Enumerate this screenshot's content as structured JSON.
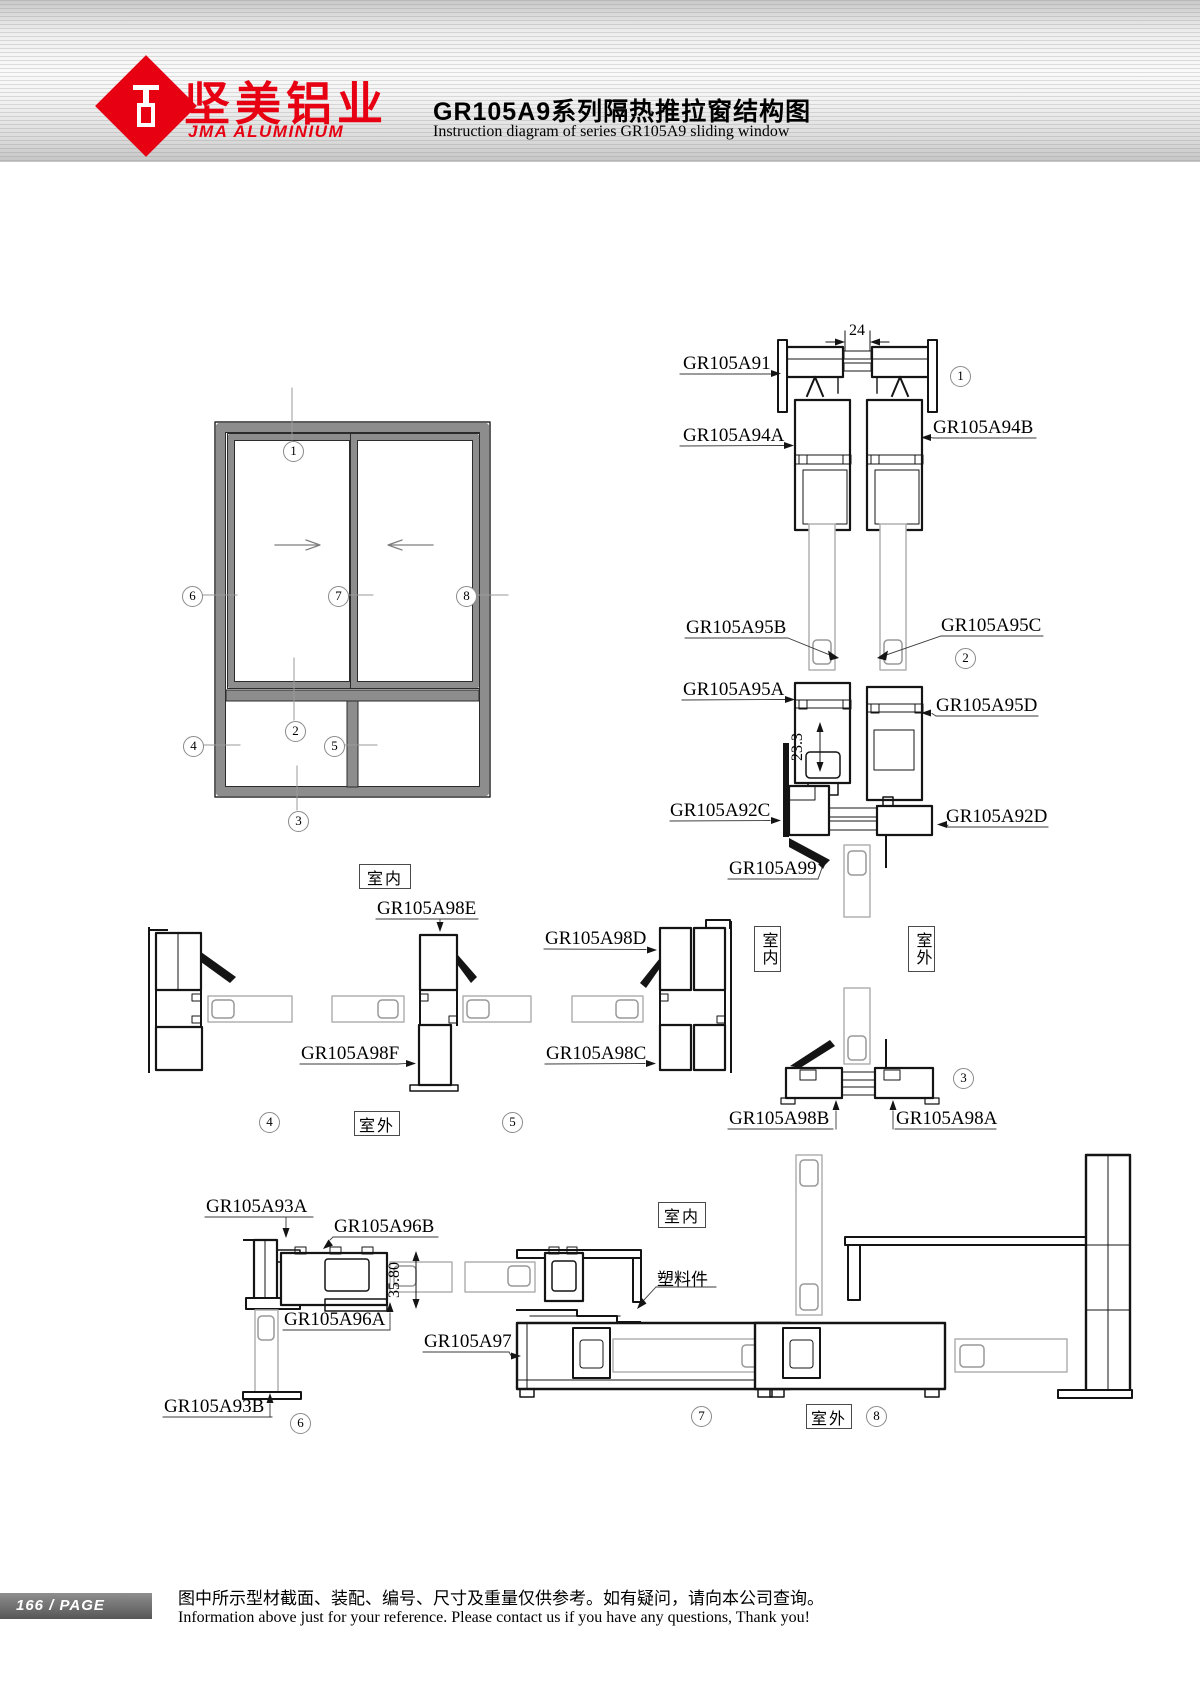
{
  "header": {
    "logo_cn": "坚美铝业",
    "logo_en": "JMA ALUMINIUM",
    "title_cn": "GR105A9系列隔热推拉窗结构图",
    "title_en": "Instruction diagram of series GR105A9 sliding window"
  },
  "marks": [
    "1",
    "2",
    "3",
    "4",
    "5",
    "6",
    "7",
    "8"
  ],
  "rooms": {
    "indoor": "室内",
    "outdoor": "室外"
  },
  "dims": {
    "gap": "24",
    "offset": "23.3",
    "depth": "35.80"
  },
  "parts": {
    "gr105a91": "GR105A91",
    "gr105a94a": "GR105A94A",
    "gr105a94b": "GR105A94B",
    "gr105a95a": "GR105A95A",
    "gr105a95b": "GR105A95B",
    "gr105a95c": "GR105A95C",
    "gr105a95d": "GR105A95D",
    "gr105a92c": "GR105A92C",
    "gr105a92d": "GR105A92D",
    "gr105a99": "GR105A99",
    "gr105a98a": "GR105A98A",
    "gr105a98b": "GR105A98B",
    "gr105a98c": "GR105A98C",
    "gr105a98d": "GR105A98D",
    "gr105a98e": "GR105A98E",
    "gr105a98f": "GR105A98F",
    "gr105a93a": "GR105A93A",
    "gr105a93b": "GR105A93B",
    "gr105a96a": "GR105A96A",
    "gr105a96b": "GR105A96B",
    "gr105a97": "GR105A97",
    "plastic_part": "塑料件"
  },
  "footer": {
    "page_badge": "166 / PAGE",
    "note_cn": "图中所示型材截面、装配、编号、尺寸及重量仅供参考。如有疑问，请向本公司查询。",
    "note_en": "Information above just for your reference. Please contact us if you have any questions, Thank you!"
  }
}
